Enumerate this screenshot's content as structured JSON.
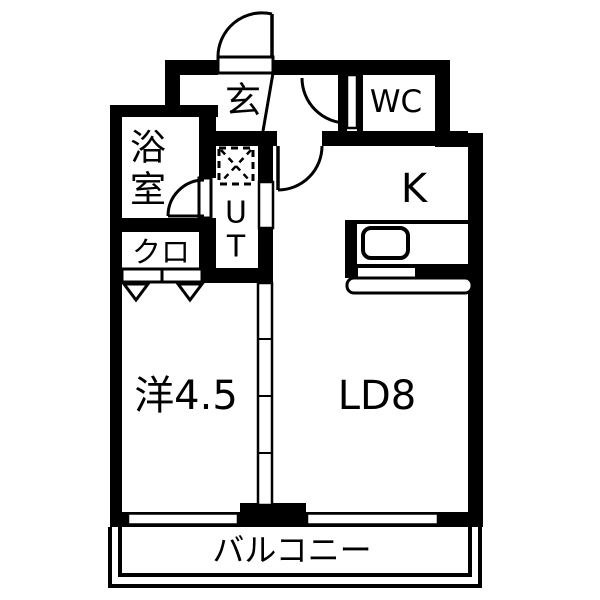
{
  "title": "apartment-floor-plan",
  "colors": {
    "wall": "#000000",
    "background": "#ffffff",
    "text": "#000000"
  },
  "labels": {
    "entrance": "玄",
    "toilet": "WC",
    "bathroom_line1": "浴",
    "bathroom_line2": "室",
    "utility_line1": "U",
    "utility_line2": "T",
    "closet": "クロ",
    "kitchen": "K",
    "western_room": "洋4.5",
    "living_dining": "LD8",
    "balcony": "バルコニー"
  },
  "rooms": [
    {
      "id": "entrance",
      "label": "玄"
    },
    {
      "id": "toilet",
      "label": "WC"
    },
    {
      "id": "bathroom",
      "label": "浴室"
    },
    {
      "id": "utility",
      "label": "UT"
    },
    {
      "id": "closet",
      "label": "クロ"
    },
    {
      "id": "kitchen",
      "label": "K"
    },
    {
      "id": "western-room",
      "label": "洋4.5"
    },
    {
      "id": "living-dining",
      "label": "LD8"
    },
    {
      "id": "balcony",
      "label": "バルコニー"
    }
  ]
}
